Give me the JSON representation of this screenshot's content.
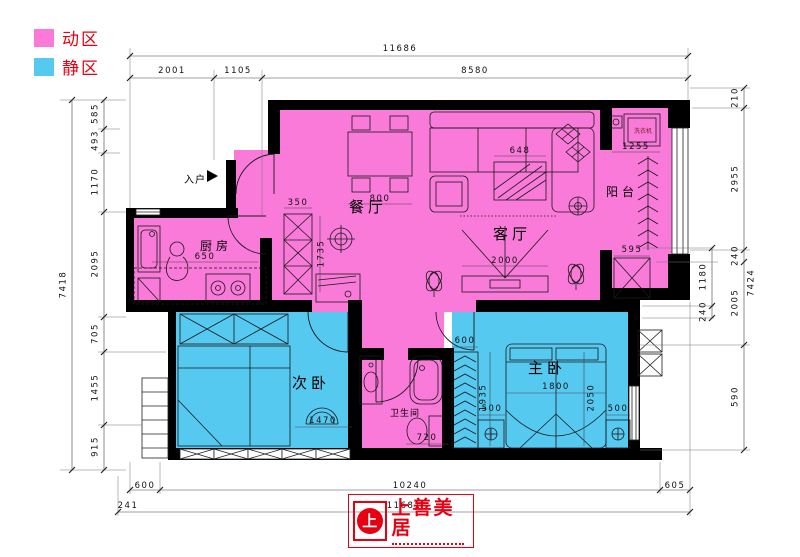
{
  "legend": {
    "active": "动区",
    "quiet": "静区"
  },
  "colors": {
    "active": "#f97ad9",
    "quiet": "#56c9f1",
    "red": "#e60012",
    "wall": "#000000"
  },
  "rooms": {
    "dining": "餐厅",
    "living": "客厅",
    "kitchen": "厨房",
    "balcony": "阳台",
    "bedroom2": "次卧",
    "master": "主卧",
    "bath": "卫生间"
  },
  "labels": {
    "entry": "入户",
    "washer": "洗衣机"
  },
  "logo": {
    "name": "上善美居",
    "mark": "上"
  },
  "dims": {
    "top": {
      "total": "11686",
      "segs": [
        "2001",
        "1105",
        "8580"
      ]
    },
    "left": {
      "total": "7418",
      "segs": [
        "585",
        "493",
        "1170",
        "2095",
        "705",
        "1455",
        "915"
      ]
    },
    "right": {
      "total": "7424",
      "outer": [
        "210",
        "2955",
        "240",
        "2005",
        "590"
      ],
      "inner": [
        "1180",
        "240"
      ]
    },
    "bottom": {
      "segs": [
        "600",
        "10240",
        "605"
      ],
      "offset": "241",
      "total": "11681"
    },
    "interior": {
      "hall_w": "350",
      "hall_h": "1735",
      "table": "800",
      "coffee": "648",
      "tv": "2000",
      "counter": "650",
      "washer": "1255",
      "bal_cab": "595",
      "seat": "1470",
      "toilet": "720",
      "bed_w": "1800",
      "bed_d": "2050",
      "ns_l": "500",
      "ns_r": "500",
      "ward_w": "600",
      "ward_h": "1935"
    }
  }
}
